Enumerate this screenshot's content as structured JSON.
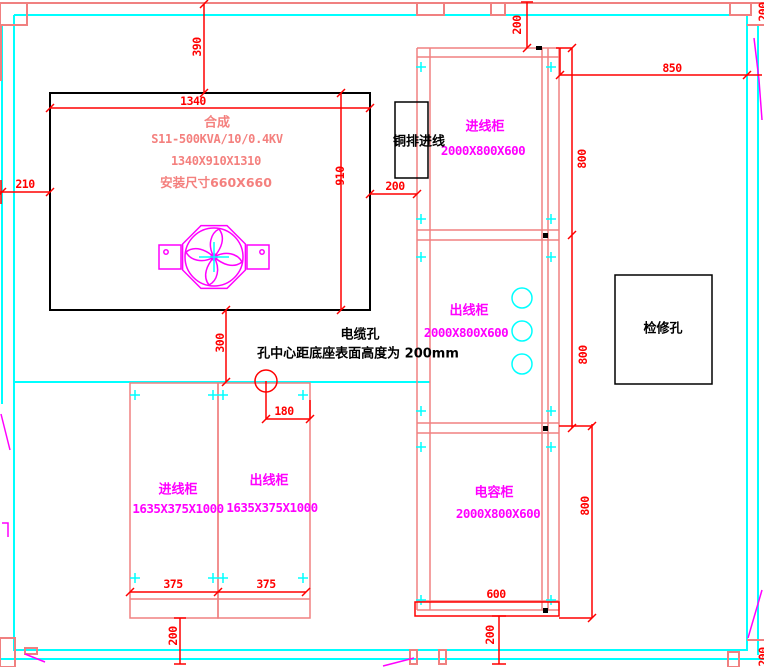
{
  "colors": {
    "wall_cyan": "#00ffff",
    "cabinet_salmon": "#f08080",
    "dimension_red": "#ff0000",
    "label_magenta": "#ff00ff",
    "transformer_pink": "#f4807e",
    "ink_black": "#000000"
  },
  "transformer": {
    "title": "合成",
    "model": "S11-500KVA/10/0.4KV",
    "size": "1340X910X1310",
    "install": "安装尺寸660X660"
  },
  "cabinets": {
    "incoming": {
      "name": "进线柜",
      "size": "2000X800X600"
    },
    "outgoing": {
      "name": "出线柜",
      "size": "2000X800X600"
    },
    "capacitor": {
      "name": "电容柜",
      "size": "2000X800X600"
    },
    "small_incoming": {
      "name": "进线柜",
      "size": "1635X375X1000"
    },
    "small_outgoing": {
      "name": "出线柜",
      "size": "1635X375X1000"
    }
  },
  "annotations": {
    "busbar_entry": "铜排进线",
    "cable_hole_title": "电缆孔",
    "cable_hole_note": "孔中心距底座表面高度为 200mm",
    "inspection_hole": "检修孔"
  },
  "dim_labels": [
    {
      "value": "390",
      "x": 197,
      "y": 47,
      "rot": true
    },
    {
      "value": "1340",
      "x": 193,
      "y": 101,
      "rot": false
    },
    {
      "value": "910",
      "x": 340,
      "y": 176,
      "rot": true
    },
    {
      "value": "210",
      "x": 25,
      "y": 184,
      "rot": false
    },
    {
      "value": "200",
      "x": 395,
      "y": 186,
      "rot": false
    },
    {
      "value": "300",
      "x": 220,
      "y": 343,
      "rot": true
    },
    {
      "value": "180",
      "x": 284,
      "y": 411,
      "rot": false
    },
    {
      "value": "375",
      "x": 173,
      "y": 584,
      "rot": false
    },
    {
      "value": "375",
      "x": 266,
      "y": 584,
      "rot": false
    },
    {
      "value": "200",
      "x": 173,
      "y": 636,
      "rot": true
    },
    {
      "value": "200",
      "x": 517,
      "y": 25,
      "rot": true
    },
    {
      "value": "850",
      "x": 672,
      "y": 68,
      "rot": false
    },
    {
      "value": "800",
      "x": 582,
      "y": 159,
      "rot": true
    },
    {
      "value": "800",
      "x": 583,
      "y": 355,
      "rot": true
    },
    {
      "value": "800",
      "x": 585,
      "y": 506,
      "rot": true
    },
    {
      "value": "600",
      "x": 496,
      "y": 594,
      "rot": false
    },
    {
      "value": "200",
      "x": 490,
      "y": 635,
      "rot": true
    },
    {
      "value": "200",
      "x": 763,
      "y": 12,
      "rot": true
    },
    {
      "value": "200",
      "x": 763,
      "y": 657,
      "rot": true
    }
  ]
}
